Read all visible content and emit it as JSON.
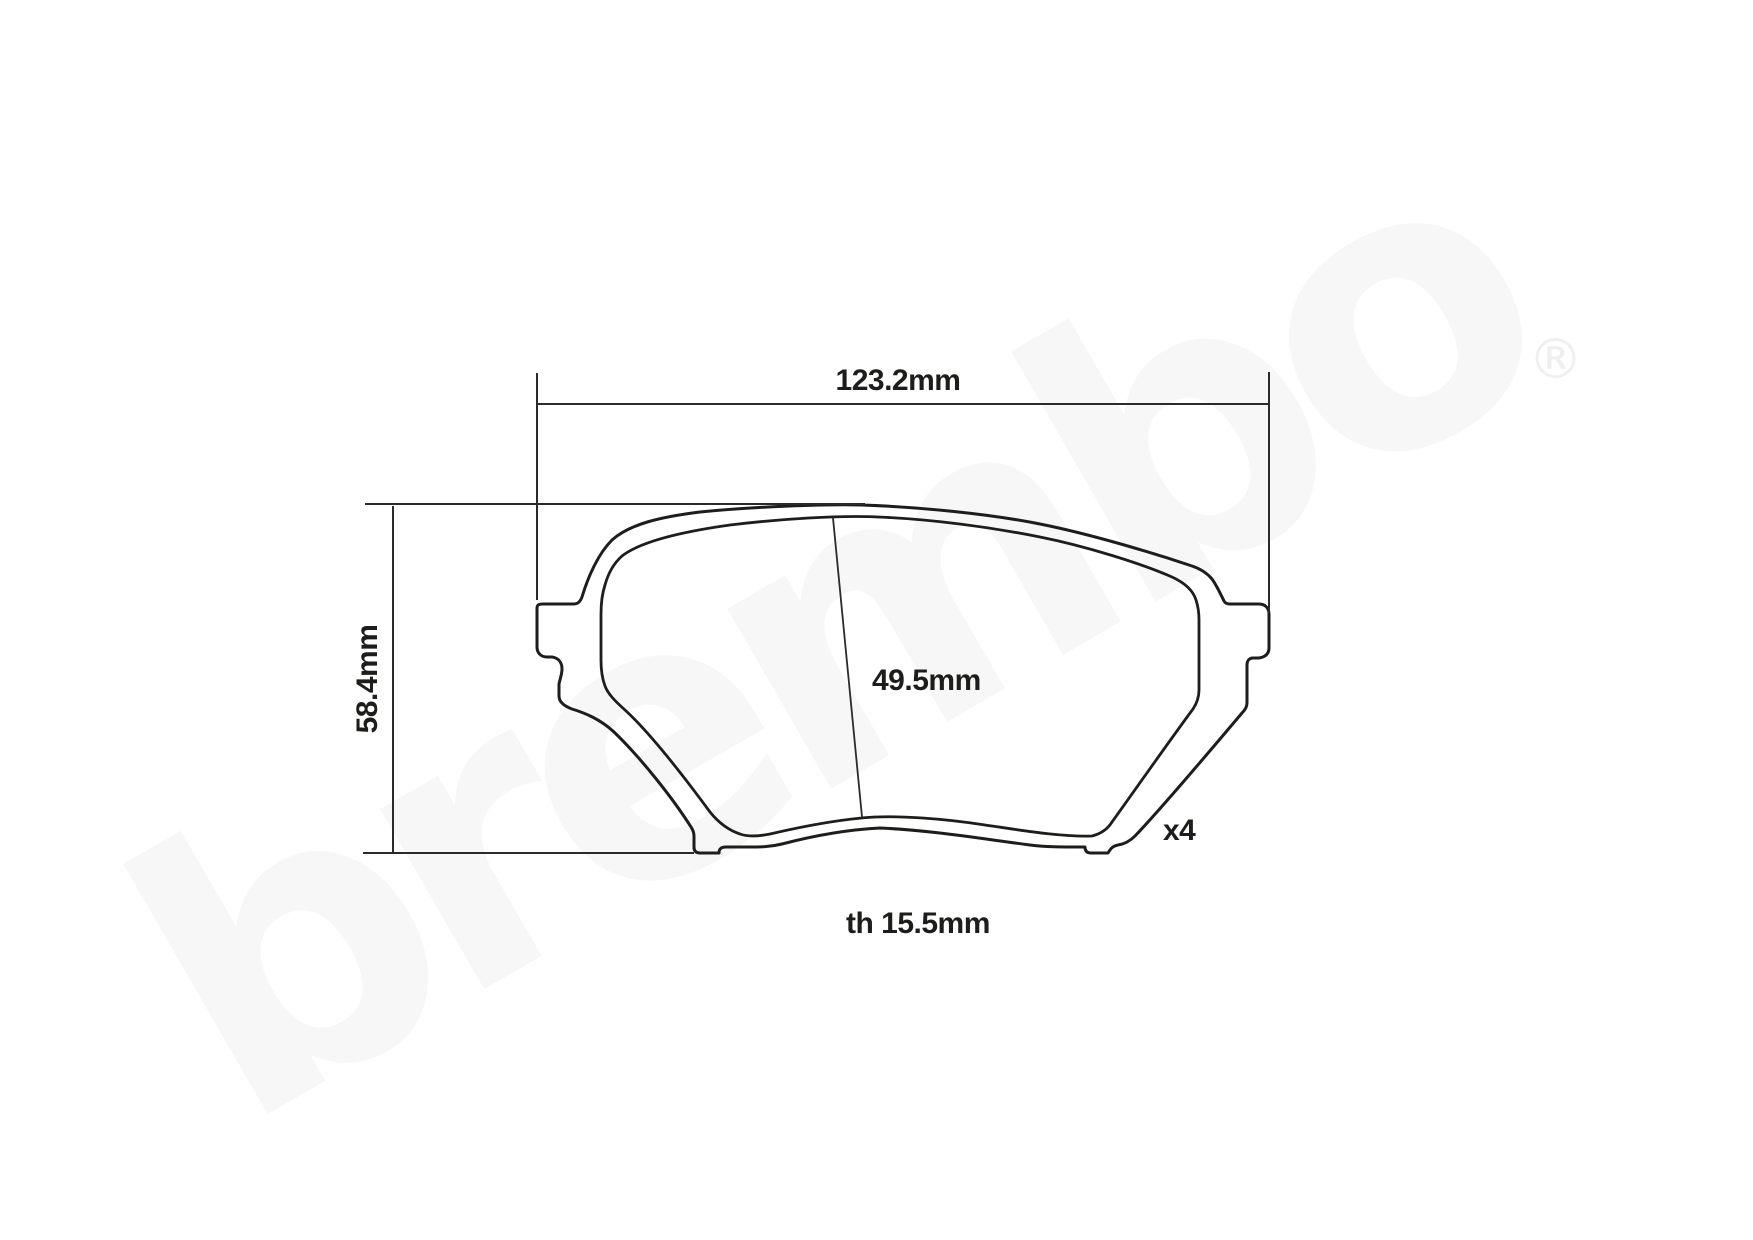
{
  "watermark": {
    "wordmark": "brembo",
    "registered": "®",
    "color": "#f7f7f7",
    "registered_color": "#efefef"
  },
  "drawing": {
    "line_color": "#1d1d1b",
    "dim_line_color": "#2b2b2b",
    "labels": {
      "overall_width": "123.2mm",
      "overall_height": "58.4mm",
      "friction_height": "49.5mm",
      "quantity": "x4",
      "thickness": "th 15.5mm"
    }
  }
}
